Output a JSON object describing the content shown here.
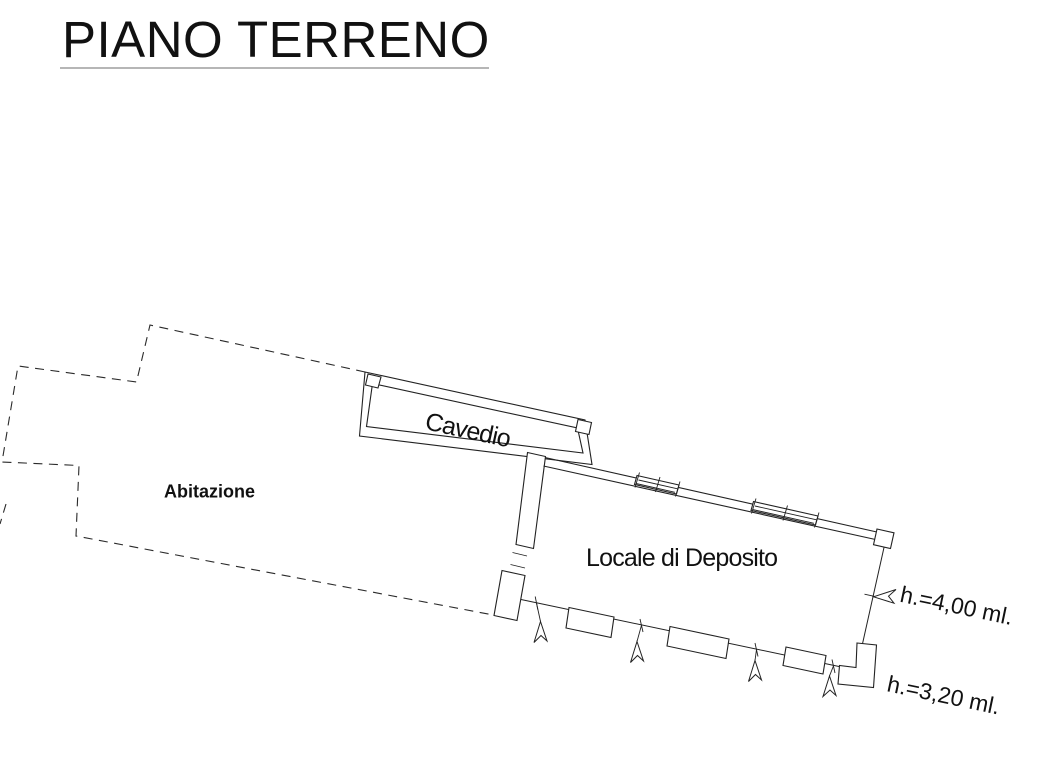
{
  "sheet": {
    "title": "PIANO TERRENO",
    "background": "#ffffff",
    "line_color": "#222222",
    "underline_color": "#8b8b8b",
    "text_color": "#111111"
  },
  "rooms": {
    "abitazione": {
      "label": "Abitazione",
      "outline_style": "dashed"
    },
    "cavedio": {
      "label": "Cavedio",
      "outline_style": "solid-double-wall"
    },
    "deposito": {
      "label": "Locale di Deposito",
      "outline_style": "solid-double-wall"
    }
  },
  "annotations": {
    "height_main": {
      "text": "h.=4,00 ml."
    },
    "height_secondary": {
      "text": "h.=3,20 ml."
    }
  },
  "symbols": {
    "window_symbols": 2,
    "entrance_arrows": 4,
    "leader_arrows": 1,
    "pillars": 6
  }
}
